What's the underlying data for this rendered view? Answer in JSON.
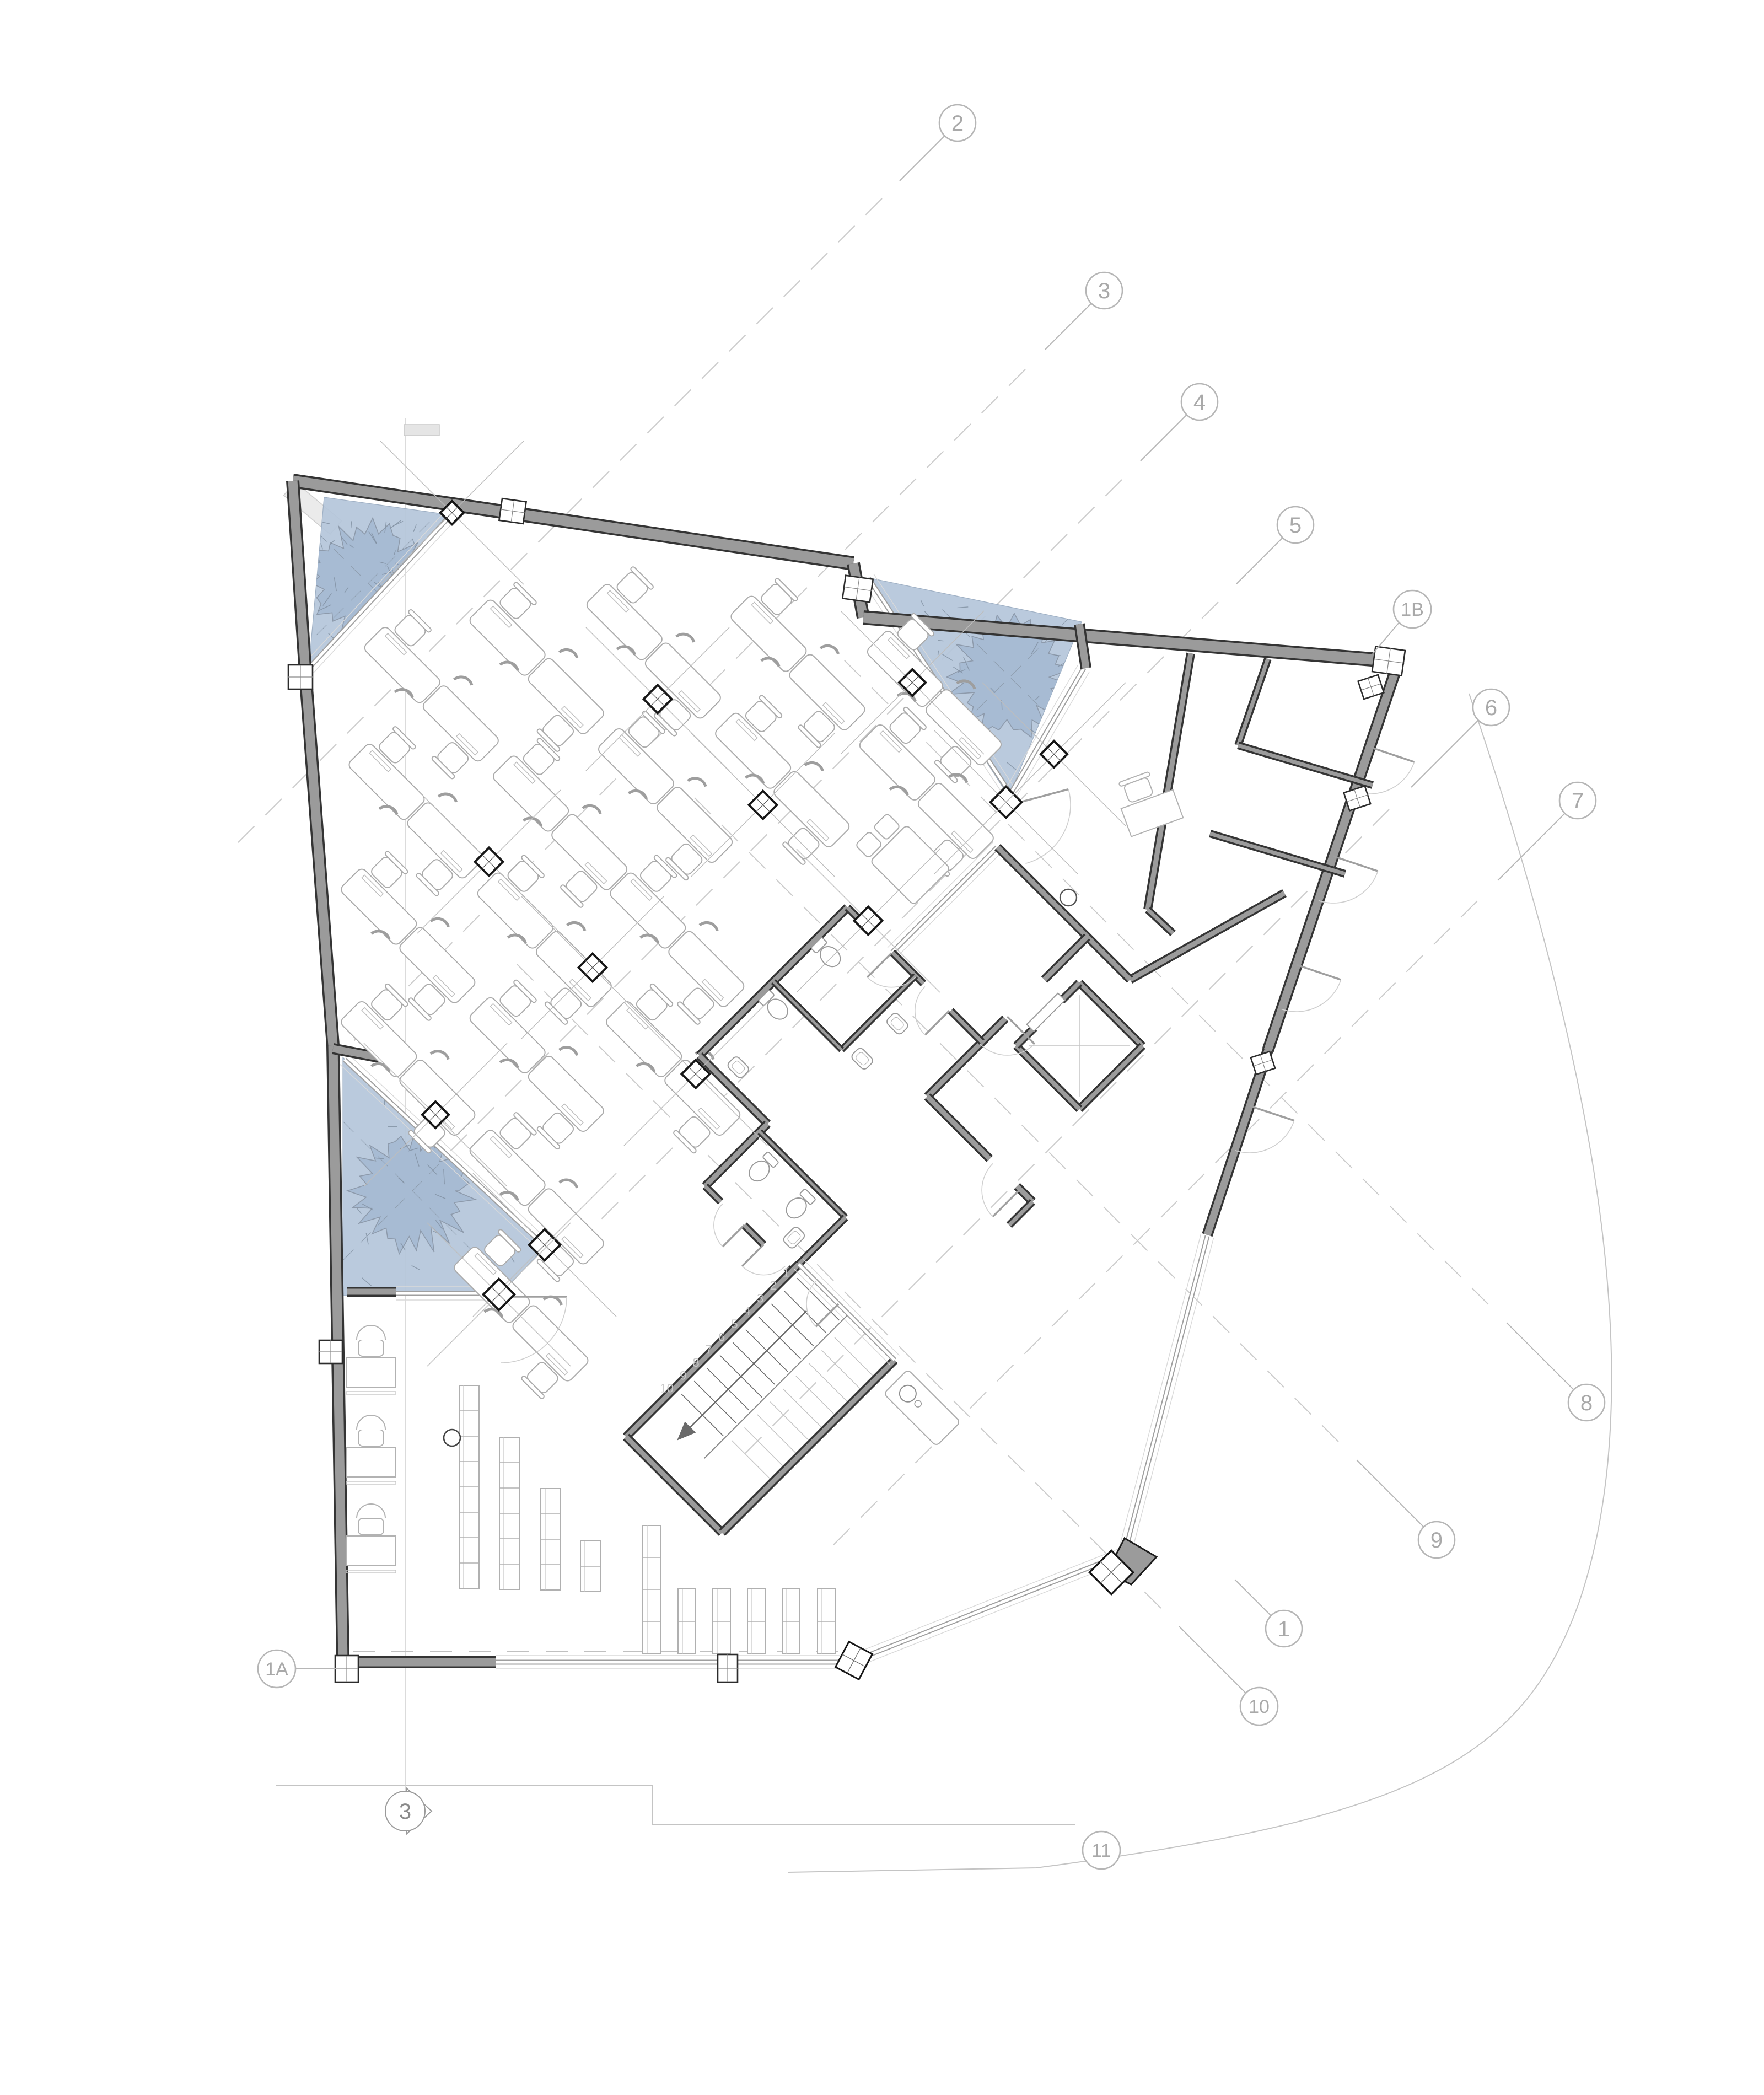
{
  "drawing": {
    "kind": "architectural floor plan",
    "level": "office floor with terraces, core, stair and open workspace"
  },
  "grid_markers": [
    {
      "id": "2",
      "label": "2"
    },
    {
      "id": "3",
      "label": "3"
    },
    {
      "id": "4",
      "label": "4"
    },
    {
      "id": "5",
      "label": "5"
    },
    {
      "id": "1B",
      "label": "1B"
    },
    {
      "id": "6",
      "label": "6"
    },
    {
      "id": "7",
      "label": "7"
    },
    {
      "id": "8",
      "label": "8"
    },
    {
      "id": "9",
      "label": "9"
    },
    {
      "id": "1",
      "label": "1"
    },
    {
      "id": "10",
      "label": "10"
    },
    {
      "id": "11",
      "label": "11"
    },
    {
      "id": "1A",
      "label": "1A"
    }
  ],
  "section_markers": [
    {
      "id": "3",
      "label": "3"
    }
  ],
  "stair": {
    "tread_labels": [
      "1",
      "2",
      "3",
      "4",
      "5",
      "6",
      "7",
      "8",
      "9",
      "10"
    ]
  },
  "colors": {
    "terrace_fill": "#b4c6da",
    "tree_fill": "#a5b9d2",
    "tree_edge": "#8d9aab",
    "wall_gray": "#9b9b9b",
    "wall_edge": "#343434",
    "glass": "#9f9f9f",
    "furniture": "#adadad",
    "line_light": "#c9c9c9"
  }
}
